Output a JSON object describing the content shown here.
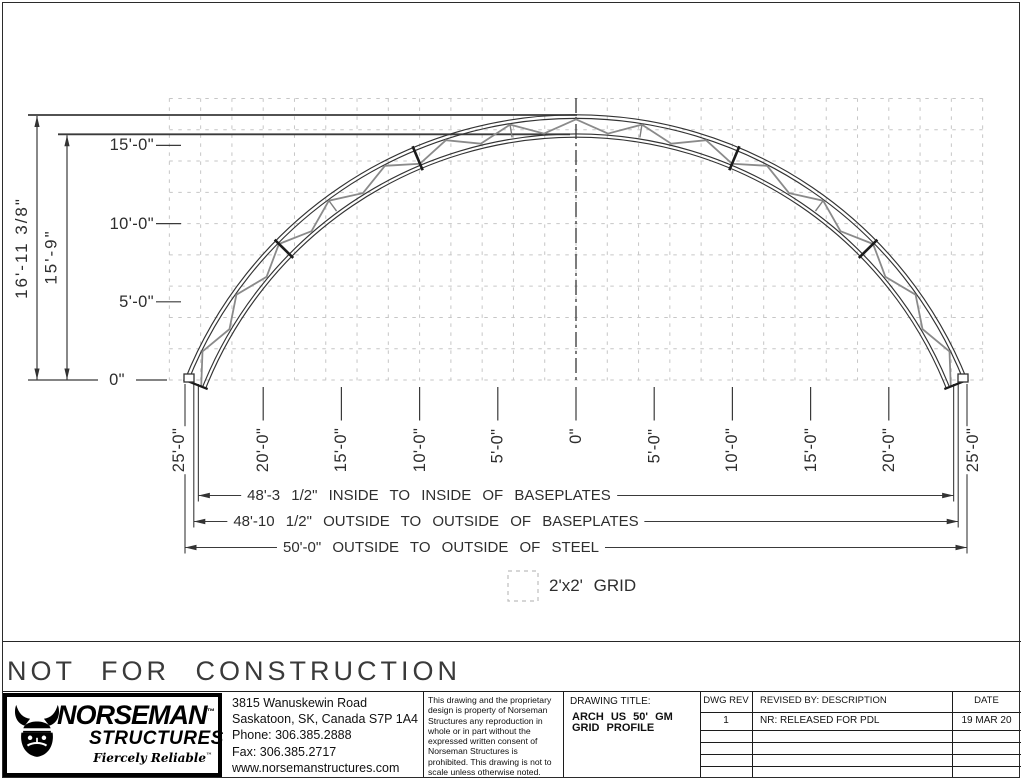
{
  "sheet": {
    "watermark": "NOT FOR CONSTRUCTION",
    "grid_legend": "2'x2' GRID"
  },
  "drawing": {
    "vertical_dims": [
      {
        "label": "16'-11 3/8\"",
        "feet": 16.948
      },
      {
        "label": "15'-9\"",
        "feet": 15.75
      }
    ],
    "y_axis_labels": [
      {
        "label": "15'-0\"",
        "feet": 15
      },
      {
        "label": "10'-0\"",
        "feet": 10
      },
      {
        "label": "5'-0\"",
        "feet": 5
      },
      {
        "label": "0\"",
        "feet": 0
      }
    ],
    "x_axis_labels": [
      {
        "label": "25'-0\"",
        "feet": -25
      },
      {
        "label": "20'-0\"",
        "feet": -20
      },
      {
        "label": "15'-0\"",
        "feet": -15
      },
      {
        "label": "10'-0\"",
        "feet": -10
      },
      {
        "label": "5'-0\"",
        "feet": -5
      },
      {
        "label": "0\"",
        "feet": 0
      },
      {
        "label": "5'-0\"",
        "feet": 5
      },
      {
        "label": "10'-0\"",
        "feet": 10
      },
      {
        "label": "15'-0\"",
        "feet": 15
      },
      {
        "label": "20'-0\"",
        "feet": 20
      },
      {
        "label": "25'-0\"",
        "feet": 25
      }
    ],
    "span_dims": [
      {
        "label": "48'-3 1/2\" INSIDE TO INSIDE OF BASEPLATES",
        "half_feet": 24.1458
      },
      {
        "label": "48'-10 1/2\" OUTSIDE TO OUTSIDE OF BASEPLATES",
        "half_feet": 24.4375
      },
      {
        "label": "50'-0\" OUTSIDE TO OUTSIDE OF STEEL",
        "half_feet": 25
      }
    ]
  },
  "title_block": {
    "logo": {
      "brand": "NORSEMAN",
      "brand_tm": "™",
      "sub": "STRUCTURES",
      "tagline": "Fiercely Reliable",
      "tagline_tm": "™"
    },
    "address": [
      "3815 Wanuskewin Road",
      "Saskatoon, SK, Canada S7P 1A4",
      "Phone: 306.385.2888",
      "Fax: 306.385.2717",
      "www.norsemanstructures.com"
    ],
    "disclaimer": "This drawing and the proprietary design is property of Norseman Structures any reproduction in whole or in part without the expressed written consent of Norseman Structures is prohibited. This drawing is not to scale unless otherwise noted.",
    "drawing_title_label": "DRAWING TITLE:",
    "drawing_title": "ARCH US 50' GM GRID PROFILE",
    "rev_table": {
      "headers": [
        "DWG REV",
        "REVISED BY: DESCRIPTION",
        "DATE"
      ],
      "rows": [
        [
          "1",
          "NR: RELEASED FOR PDL",
          "19 MAR 20"
        ]
      ],
      "empty_row_count": 4
    }
  },
  "colors": {
    "line": "#3a3a3a",
    "chord": "#333333",
    "web": "#8a8a8a",
    "splice": "#1b1b1b",
    "grid": "#c6c6c6",
    "text": "#2e2e2e"
  }
}
